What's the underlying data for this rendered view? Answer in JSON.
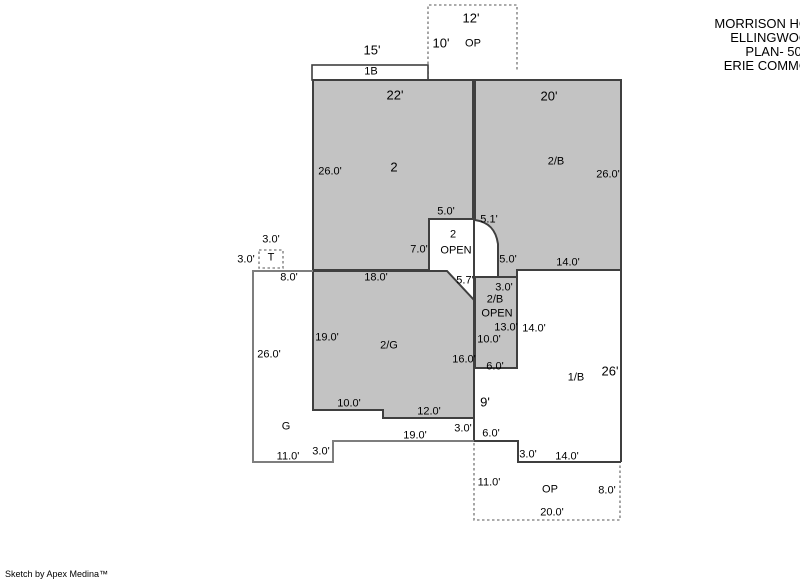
{
  "title_block": {
    "lines": [
      "MORRISON HO",
      "ELLINGWOO",
      "PLAN- 508",
      "ERIE COMMO"
    ]
  },
  "footer": {
    "credit": "Sketch by Apex Medina™"
  },
  "colors": {
    "area_fill": "#c3c3c3",
    "outline_dark": "#3f3f3f",
    "outline_medium": "#7e7e7e",
    "dashed": "#8f8f8f",
    "background": "#ffffff",
    "text": "#000000"
  },
  "plan": {
    "labels": [
      {
        "text": "12'",
        "x": 471,
        "y": 18,
        "size": "lg",
        "kind": "dim"
      },
      {
        "text": "10'",
        "x": 441,
        "y": 43,
        "size": "lg",
        "kind": "dim"
      },
      {
        "text": "OP",
        "x": 473,
        "y": 44,
        "kind": "area"
      },
      {
        "text": "15'",
        "x": 372,
        "y": 50,
        "size": "lg",
        "kind": "dim"
      },
      {
        "text": "1B",
        "x": 371,
        "y": 72,
        "kind": "area"
      },
      {
        "text": "22'",
        "x": 395,
        "y": 95,
        "size": "lg",
        "kind": "dim"
      },
      {
        "text": "20'",
        "x": 549,
        "y": 96,
        "size": "lg",
        "kind": "dim"
      },
      {
        "text": "26.0'",
        "x": 330,
        "y": 172,
        "kind": "dim"
      },
      {
        "text": "2",
        "x": 394,
        "y": 167,
        "size": "lg",
        "kind": "area"
      },
      {
        "text": "2/B",
        "x": 556,
        "y": 162,
        "kind": "area"
      },
      {
        "text": "26.0'",
        "x": 608,
        "y": 175,
        "kind": "dim"
      },
      {
        "text": "5.0'",
        "x": 446,
        "y": 212,
        "kind": "dim"
      },
      {
        "text": "5.1'",
        "x": 489,
        "y": 220,
        "kind": "dim"
      },
      {
        "text": "2",
        "x": 453,
        "y": 235,
        "kind": "area"
      },
      {
        "text": "OPEN",
        "x": 456,
        "y": 251,
        "kind": "area"
      },
      {
        "text": "7.0'",
        "x": 419,
        "y": 250,
        "kind": "dim"
      },
      {
        "text": "5.0'",
        "x": 508,
        "y": 260,
        "kind": "dim"
      },
      {
        "text": "14.0'",
        "x": 568,
        "y": 263,
        "kind": "dim"
      },
      {
        "text": "5.7'",
        "x": 465,
        "y": 281,
        "kind": "dim"
      },
      {
        "text": "3.0'",
        "x": 504,
        "y": 288,
        "kind": "dim"
      },
      {
        "text": "2/B",
        "x": 495,
        "y": 300,
        "kind": "area"
      },
      {
        "text": "OPEN",
        "x": 497,
        "y": 314,
        "kind": "area"
      },
      {
        "text": "13.0'",
        "x": 506,
        "y": 328,
        "kind": "dim"
      },
      {
        "text": "14.0'",
        "x": 534,
        "y": 329,
        "kind": "dim"
      },
      {
        "text": "10.0'",
        "x": 489,
        "y": 340,
        "kind": "dim"
      },
      {
        "text": "3.0'",
        "x": 271,
        "y": 240,
        "kind": "dim"
      },
      {
        "text": "3.0'",
        "x": 246,
        "y": 260,
        "kind": "dim"
      },
      {
        "text": "T",
        "x": 271,
        "y": 258,
        "kind": "area"
      },
      {
        "text": "8.0'",
        "x": 289,
        "y": 278,
        "kind": "dim"
      },
      {
        "text": "18.0'",
        "x": 376,
        "y": 278,
        "kind": "dim"
      },
      {
        "text": "19.0'",
        "x": 327,
        "y": 338,
        "kind": "dim"
      },
      {
        "text": "2/G",
        "x": 389,
        "y": 346,
        "kind": "area"
      },
      {
        "text": "26.0'",
        "x": 269,
        "y": 355,
        "kind": "dim"
      },
      {
        "text": "16.0'",
        "x": 464,
        "y": 360,
        "kind": "dim"
      },
      {
        "text": "6.0'",
        "x": 495,
        "y": 367,
        "kind": "dim"
      },
      {
        "text": "26'",
        "x": 610,
        "y": 371,
        "size": "lg",
        "kind": "dim"
      },
      {
        "text": "1/B",
        "x": 576,
        "y": 378,
        "kind": "area"
      },
      {
        "text": "10.0'",
        "x": 349,
        "y": 404,
        "kind": "dim"
      },
      {
        "text": "9'",
        "x": 485,
        "y": 402,
        "size": "lg",
        "kind": "dim"
      },
      {
        "text": "12.0'",
        "x": 429,
        "y": 412,
        "kind": "dim"
      },
      {
        "text": "G",
        "x": 286,
        "y": 427,
        "kind": "area"
      },
      {
        "text": "3.0'",
        "x": 463,
        "y": 429,
        "kind": "dim"
      },
      {
        "text": "19.0'",
        "x": 415,
        "y": 436,
        "kind": "dim"
      },
      {
        "text": "6.0'",
        "x": 491,
        "y": 434,
        "kind": "dim"
      },
      {
        "text": "3.0'",
        "x": 321,
        "y": 452,
        "kind": "dim"
      },
      {
        "text": "11.0'",
        "x": 288,
        "y": 457,
        "kind": "dim"
      },
      {
        "text": "3.0'",
        "x": 528,
        "y": 455,
        "kind": "dim"
      },
      {
        "text": "14.0'",
        "x": 567,
        "y": 457,
        "kind": "dim"
      },
      {
        "text": "11.0'",
        "x": 489,
        "y": 483,
        "kind": "dim"
      },
      {
        "text": "OP",
        "x": 550,
        "y": 490,
        "kind": "area"
      },
      {
        "text": "8.0'",
        "x": 607,
        "y": 491,
        "kind": "dim"
      },
      {
        "text": "20.0'",
        "x": 552,
        "y": 513,
        "kind": "dim"
      }
    ]
  }
}
